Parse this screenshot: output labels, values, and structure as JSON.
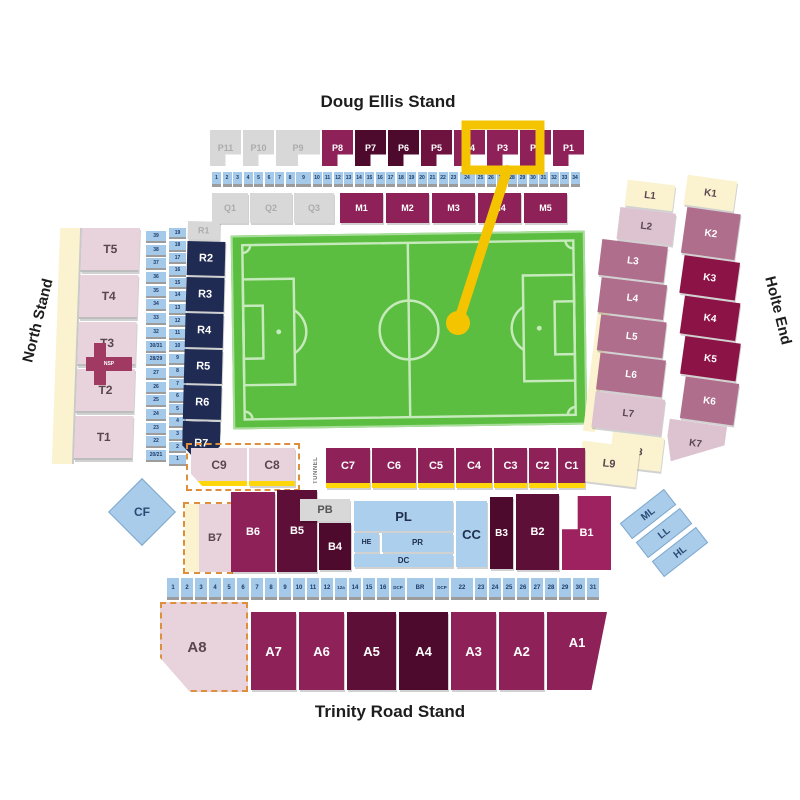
{
  "palette": {
    "claret": "#8E2158",
    "claret2": "#9E2260",
    "dark": "#5E0F38",
    "darkest": "#4D0A2D",
    "dark2": "#6E1240",
    "gray": "#D8D8D8",
    "navy": "#1F2B52",
    "blue": "#A5C9E9",
    "bluelg": "#ABCFEC",
    "pink": "#E8D3DC",
    "lightpink": "#DCC3CF",
    "mauve": "#AF6E8C",
    "darkrasp": "#8C1345",
    "cream": "#FBF2CF",
    "green": "#5CBE41",
    "yellow": "#F5C400",
    "stripe": "#FFD60A",
    "orange_dash": "#DD8F3D",
    "nsp": "#A03A63"
  },
  "annotation": {
    "highlighted_sections": "P3, P2",
    "color": "#F5C400"
  },
  "stands": {
    "doug_ellis": {
      "title": "Doug Ellis Stand",
      "p_sections": [
        {
          "label": "P11",
          "color": "gray"
        },
        {
          "label": "P10",
          "color": "gray"
        },
        {
          "label": "P9",
          "color": "gray"
        },
        {
          "label": "P8",
          "color": "claret"
        },
        {
          "label": "P7",
          "color": "darkest"
        },
        {
          "label": "P6",
          "color": "darkest"
        },
        {
          "label": "P5",
          "color": "dark2"
        },
        {
          "label": "P4",
          "color": "claret"
        },
        {
          "label": "P3",
          "color": "claret"
        },
        {
          "label": "P2",
          "color": "claret"
        },
        {
          "label": "P1",
          "color": "claret"
        }
      ],
      "row_numbers": [
        "1",
        "2",
        "3",
        "4",
        "5",
        "6",
        "7",
        "8",
        "9",
        "10",
        "11",
        "12",
        "13",
        "14",
        "15",
        "16",
        "17",
        "18",
        "19",
        "20",
        "21",
        "22",
        "23",
        "24",
        "25",
        "26",
        "27",
        "28",
        "29",
        "30",
        "31",
        "32",
        "33",
        "34"
      ],
      "q_sections": [
        {
          "label": "Q1",
          "color": "gray"
        },
        {
          "label": "Q2",
          "color": "gray"
        },
        {
          "label": "Q3",
          "color": "gray"
        }
      ],
      "m_sections": [
        {
          "label": "M1",
          "color": "claret"
        },
        {
          "label": "M2",
          "color": "claret"
        },
        {
          "label": "M3",
          "color": "claret"
        },
        {
          "label": "M4",
          "color": "claret"
        },
        {
          "label": "M5",
          "color": "claret"
        }
      ]
    },
    "north": {
      "title": "North Stand",
      "t_sections": [
        {
          "label": "T5",
          "color": "pink"
        },
        {
          "label": "T4",
          "color": "pink"
        },
        {
          "label": "T3",
          "color": "pink"
        },
        {
          "label": "T2",
          "color": "pink"
        },
        {
          "label": "T1",
          "color": "pink"
        }
      ],
      "nsp_label": "NSP",
      "row_numbers_outer": [
        "39",
        "38",
        "37",
        "36",
        "35",
        "34",
        "33",
        "32",
        "30/31",
        "28/29",
        "27",
        "26",
        "25",
        "24",
        "23",
        "22",
        "20/21"
      ],
      "row_numbers_inner": [
        "19",
        "18",
        "17",
        "16",
        "15",
        "14",
        "13",
        "12",
        "11",
        "10",
        "9",
        "8",
        "7",
        "6",
        "5",
        "4",
        "3",
        "2",
        "1"
      ],
      "r_sections": [
        {
          "label": "R1",
          "color": "gray"
        },
        {
          "label": "R2",
          "color": "navy"
        },
        {
          "label": "R3",
          "color": "navy"
        },
        {
          "label": "R4",
          "color": "navy"
        },
        {
          "label": "R5",
          "color": "navy"
        },
        {
          "label": "R6",
          "color": "navy"
        },
        {
          "label": "R7",
          "color": "navy"
        }
      ]
    },
    "holte": {
      "title": "Holte End",
      "l_sections": [
        {
          "label": "L1",
          "color": "cream"
        },
        {
          "label": "L2",
          "color": "lightpink"
        },
        {
          "label": "L3",
          "color": "mauve"
        },
        {
          "label": "L4",
          "color": "mauve"
        },
        {
          "label": "L5",
          "color": "mauve"
        },
        {
          "label": "L6",
          "color": "mauve"
        },
        {
          "label": "L7",
          "color": "lightpink"
        },
        {
          "label": "L8",
          "color": "cream"
        }
      ],
      "l9_label": "L9",
      "k_sections": [
        {
          "label": "K1",
          "color": "cream"
        },
        {
          "label": "K2",
          "color": "mauve"
        },
        {
          "label": "K3",
          "color": "darkrasp"
        },
        {
          "label": "K4",
          "color": "darkrasp"
        },
        {
          "label": "K5",
          "color": "darkrasp"
        },
        {
          "label": "K6",
          "color": "mauve"
        },
        {
          "label": "K7",
          "color": "lightpink"
        }
      ]
    },
    "trinity": {
      "title": "Trinity Road Stand",
      "tunnel_label": "TUNNEL",
      "c_box_sections": [
        {
          "label": "C9",
          "color": "pink"
        },
        {
          "label": "C8",
          "color": "pink"
        }
      ],
      "c_sections": [
        {
          "label": "C7",
          "color": "claret"
        },
        {
          "label": "C6",
          "color": "claret"
        },
        {
          "label": "C5",
          "color": "claret"
        },
        {
          "label": "C4",
          "color": "claret"
        },
        {
          "label": "C3",
          "color": "claret"
        },
        {
          "label": "C2",
          "color": "claret"
        },
        {
          "label": "C1",
          "color": "claret"
        }
      ],
      "b7": "B7",
      "b6": "B6",
      "b5": "B5",
      "b4": "B4",
      "b3": "B3",
      "b2": "B2",
      "b1": "B1",
      "pb": "PB",
      "pl": "PL",
      "he": "HE",
      "pr": "PR",
      "dc": "DC",
      "cc": "CC",
      "cf": "CF",
      "row_numbers": [
        "1",
        "2",
        "3",
        "4",
        "5",
        "6",
        "7",
        "8",
        "9",
        "10",
        "11",
        "12",
        "12a",
        "14",
        "15",
        "16",
        "DCP",
        "BR",
        "DCP",
        "22",
        "23",
        "24",
        "25",
        "26",
        "27",
        "28",
        "29",
        "30",
        "31"
      ],
      "a8": "A8",
      "a_sections": [
        {
          "label": "A7",
          "color": "claret"
        },
        {
          "label": "A6",
          "color": "claret"
        },
        {
          "label": "A5",
          "color": "dark"
        },
        {
          "label": "A4",
          "color": "darkest"
        },
        {
          "label": "A3",
          "color": "claret"
        },
        {
          "label": "A2",
          "color": "claret"
        },
        {
          "label": "A1",
          "color": "claret"
        }
      ],
      "suites": [
        "ML",
        "LL",
        "HL"
      ]
    }
  }
}
